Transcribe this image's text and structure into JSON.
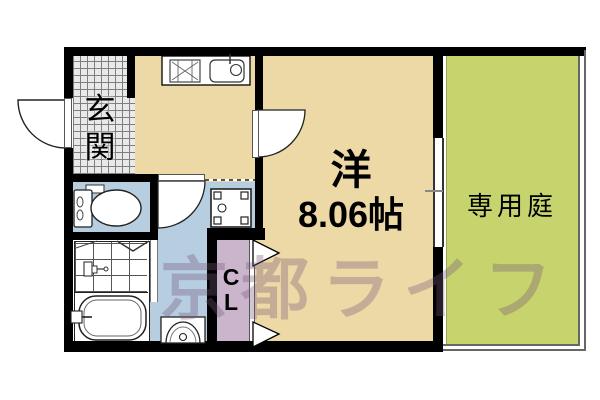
{
  "floorplan": {
    "genkan": {
      "char1": "玄",
      "char2": "関"
    },
    "western_room": {
      "type_label": "洋",
      "size_label": "8.06帖"
    },
    "closet": {
      "char1": "C",
      "char2": "L"
    },
    "garden": {
      "label": "専用庭"
    },
    "watermark": {
      "text": "京都ライフ"
    },
    "colors": {
      "floor_tan": "#ecd9a6",
      "water_blue": "#b6cedf",
      "closet_mauve": "#cab5cc",
      "garden_green": "#c7d36c",
      "genkan_tile_gray": "#e9e9e9",
      "wall_black": "#000000",
      "watermark_purple": "rgba(118,88,122,0.34)"
    },
    "icons": [
      "entry-door-arc",
      "kitchen-door-arc",
      "washroom-door-arc",
      "bath-fold-door",
      "closet-fold-door",
      "gas-stove",
      "kitchen-sink",
      "washing-machine-pan",
      "toilet",
      "bathtub",
      "shower-faucet",
      "vanity-basin",
      "window",
      "window-tick"
    ]
  }
}
